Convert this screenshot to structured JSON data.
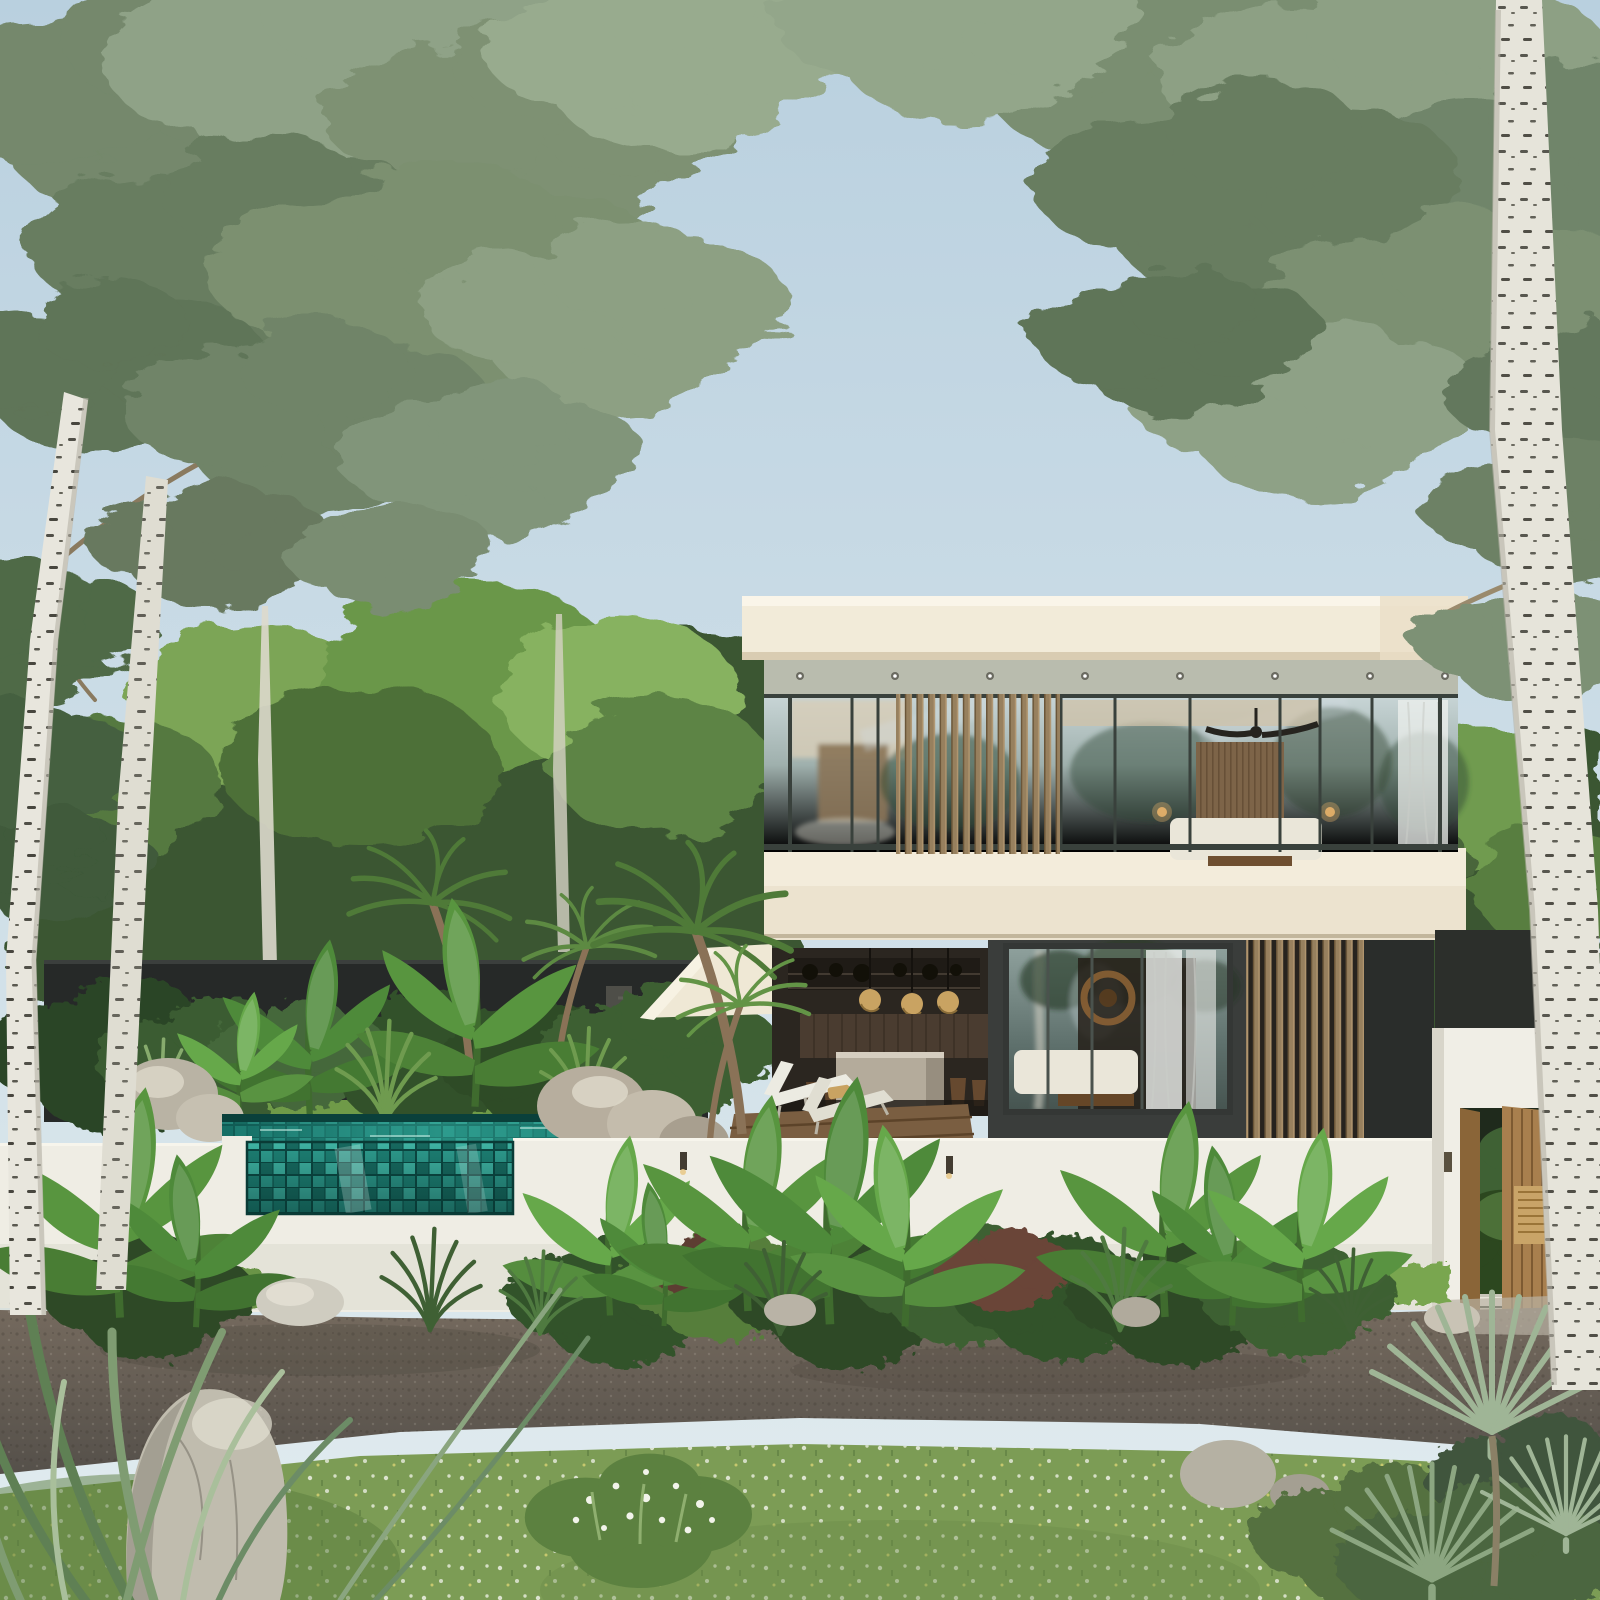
{
  "scene": {
    "type": "3D architectural exterior rendering (photoreal)",
    "description": "Modern two-storey tropical villa with floor-to-ceiling glazing and vertical timber louvers, an open-air kitchen pavilion, a mosaic-tiled pool with a glass viewing window set into a white garden wall, dark privacy wall, lush banana and palm planting, a gravel path and wildflower meadow in the foreground, all framed by tall birch trees against a pale blue sky",
    "time_of_day": "daytime, soft sunlight, clear sky"
  },
  "colors": {
    "sky_top": "#b9d0df",
    "sky_low": "#dfe9ee",
    "roof_cream": "#f2ebd9",
    "roof_edge": "#faf5e9",
    "roof_soffit": "#b9bcae",
    "slab_cream": "#ece3cf",
    "glass_light": "#c9d6d7",
    "glass_deep": "#72847f",
    "mullion": "#39413c",
    "wood_louver": "#97805e",
    "wood_dark": "#6b5639",
    "charcoal": "#3a3d3b",
    "charcoal_dark": "#2a2d2b",
    "privacy_wall": "#262928",
    "white_wall": "#efede4",
    "wall_shade": "#d8d6ca",
    "pool_deep": "#12655d",
    "pool_light": "#3aa99b",
    "tile_grout": "#0b4540",
    "lawn": "#6f9a48",
    "meadow": "#7c9c55",
    "path_light": "#756a5e",
    "path_dark": "#5a534b",
    "rock": "#c0bcae",
    "deck": "#7a5e41",
    "interior_dark": "#2b2620",
    "rattan": "#c9a362",
    "concrete_island": "#b4ab9b",
    "bed_white": "#eae6d9",
    "curtain": "#eef0ed",
    "gate_wood": "#a87f4e",
    "birch_bark": "#e8e6dd",
    "birch_leaf": "#7e9173",
    "foliage_dark": "#3b5731",
    "foliage_sun": "#7ba556",
    "banana_green": "#4e8a3a"
  },
  "objects": [
    {
      "name": "sky",
      "description": "pale blue sky, brighter toward horizon"
    },
    {
      "name": "birch-tree-left",
      "description": "tall white-barked birch framing left edge, airy grey-green canopy over top left"
    },
    {
      "name": "birch-tree-right",
      "description": "tall white-barked birch framing right edge, canopy spreading across top right"
    },
    {
      "name": "background-treeline",
      "description": "dense sunlit tropical tree line behind walls and villa"
    },
    {
      "name": "privacy-wall",
      "description": "dark charcoal rendered garden wall behind pool"
    },
    {
      "name": "outdoor-shower",
      "description": "stone outdoor shower column against privacy wall"
    },
    {
      "name": "pool",
      "description": "teal mosaic-tiled pool with dark far edge"
    },
    {
      "name": "pool-glass-window",
      "description": "transparent acrylic window in white wall revealing teal mosaic tiles underwater"
    },
    {
      "name": "front-garden-wall",
      "description": "white rendered garden wall across the site with small sconces"
    },
    {
      "name": "villa",
      "description": "two-storey flat-roofed villa, cream slabs, glass facades, vertical timber louver screens"
    },
    {
      "name": "upper-bedroom",
      "description": "glazed upper bedroom with ceiling fan, timber slat headboard wall, white bed, sheer curtain"
    },
    {
      "name": "open-kitchen",
      "description": "open-air kitchen with dark shelving, three rattan pendant lights, concrete island, timber stools"
    },
    {
      "name": "lower-bedroom",
      "description": "charcoal-framed glazed suite with stone feature wall, round rattan decor, white bed and curtains"
    },
    {
      "name": "sun-loungers",
      "description": "two white chaise longues with towel on timber deck"
    },
    {
      "name": "entry-portal",
      "description": "white gate portal with carved open timber doors, sconces and white steps"
    },
    {
      "name": "gravel-path",
      "description": "dark gravel driveway band across foreground"
    },
    {
      "name": "meadow",
      "description": "wildflower meadow strip at the very front with white blossoms"
    },
    {
      "name": "boulders",
      "description": "pale grey boulders by pool, near wall and in the meadow"
    },
    {
      "name": "planting",
      "description": "banana plants, agaves, palms, fan palms and shrubs along walls and foreground corners"
    }
  ]
}
